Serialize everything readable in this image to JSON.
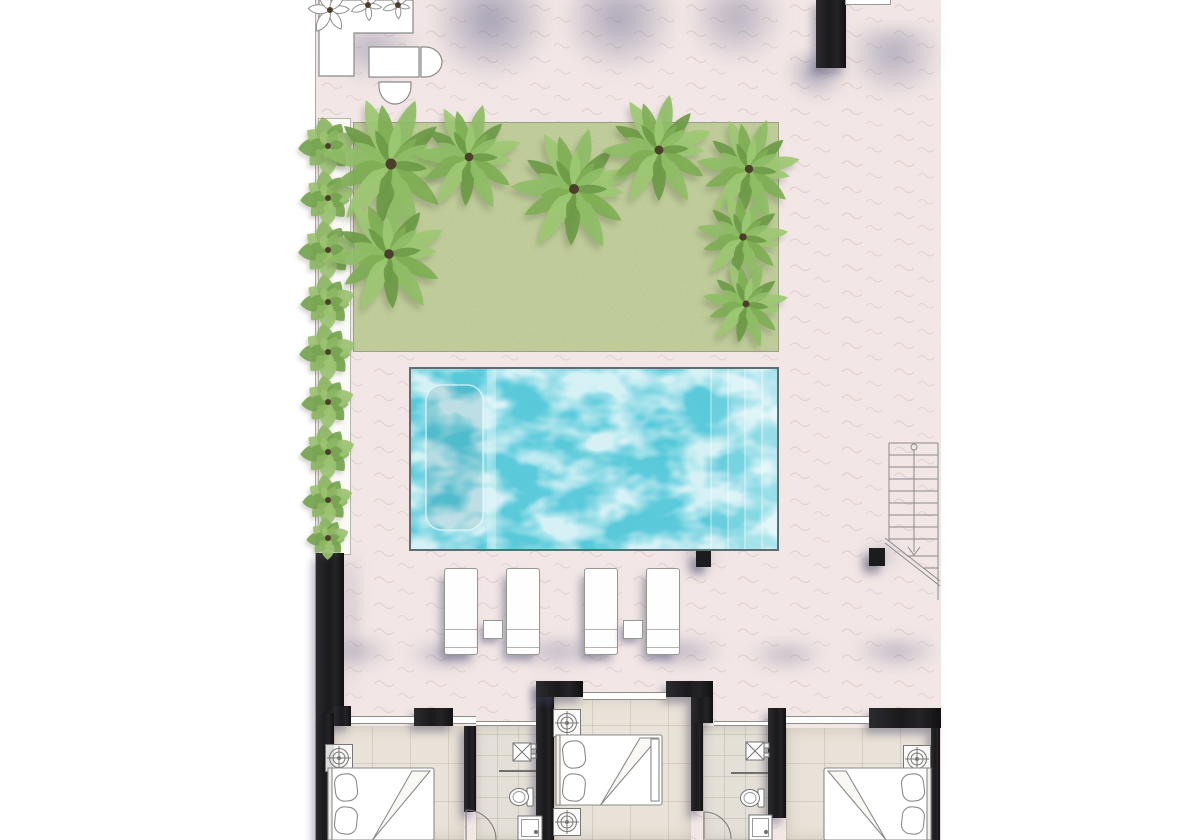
{
  "meta": {
    "title": "Villa ground-floor plan with pool, lawn and bedrooms",
    "type": "architectural-floor-plan",
    "visible_text": []
  },
  "palette": {
    "margin": "#ffffff",
    "deck": "#f4eae9",
    "deck_squiggle": "#dcc9c7",
    "shadow_tint": "88,90,130",
    "lawn": "#cdd8a4",
    "lawn_border": "#98a183",
    "pool_base": "#5ecbdc",
    "pool_highlight": "#ffffff",
    "pool_deep": "#1490ab",
    "pool_border": "#5c6e72",
    "wall": "#1c1c1e",
    "bedroom_floor": "#e9e2d8",
    "bathroom_floor": "#e4dfd7",
    "outline": "#8a8a8a",
    "furniture_fill": "#ffffff",
    "hedge_greens": [
      "#8cb663",
      "#76a44f",
      "#9cc273"
    ],
    "palm_greens": [
      "#9dc873",
      "#7fae55",
      "#8fbd66",
      "#6c9a47"
    ],
    "trunk": "#4b3e2b"
  },
  "deck_shadows": [
    {
      "x": 112,
      "y": -14,
      "w": 125,
      "h": 96,
      "o": 0.5
    },
    {
      "x": 243,
      "y": -14,
      "w": 120,
      "h": 90,
      "o": 0.45
    },
    {
      "x": 370,
      "y": -10,
      "w": 100,
      "h": 76,
      "o": 0.38
    },
    {
      "x": 528,
      "y": 28,
      "w": 100,
      "h": 72,
      "o": 0.4
    },
    {
      "x": 470,
      "y": 56,
      "w": 62,
      "h": 44,
      "o": 0.5
    },
    {
      "x": 6,
      "y": 28,
      "w": 100,
      "h": 56,
      "o": 0.35
    },
    {
      "x": 26,
      "y": 556,
      "w": 18,
      "h": 150,
      "o": 0.3
    },
    {
      "x": 2,
      "y": 640,
      "w": 75,
      "h": 30,
      "o": 0.33
    },
    {
      "x": 90,
      "y": 644,
      "w": 75,
      "h": 28,
      "o": 0.33
    },
    {
      "x": 200,
      "y": 640,
      "w": 85,
      "h": 30,
      "o": 0.35
    },
    {
      "x": 325,
      "y": 640,
      "w": 85,
      "h": 30,
      "o": 0.35
    },
    {
      "x": 430,
      "y": 644,
      "w": 80,
      "h": 28,
      "o": 0.33
    },
    {
      "x": 535,
      "y": 640,
      "w": 90,
      "h": 30,
      "o": 0.35
    },
    {
      "x": 360,
      "y": 545,
      "w": 45,
      "h": 26,
      "o": 0.3
    },
    {
      "x": 545,
      "y": 545,
      "w": 40,
      "h": 26,
      "o": 0.3
    }
  ],
  "planter": {
    "x": 2,
    "y": 118,
    "w": 33,
    "h": 437
  },
  "lawn": {
    "x": 37,
    "y": 122,
    "w": 426,
    "h": 230
  },
  "hedge": {
    "cx": 12,
    "bushes": [
      {
        "y": 146,
        "r": 29
      },
      {
        "y": 198,
        "r": 27
      },
      {
        "y": 250,
        "r": 29
      },
      {
        "y": 302,
        "r": 27
      },
      {
        "y": 352,
        "r": 28
      },
      {
        "y": 402,
        "r": 26
      },
      {
        "y": 452,
        "r": 27
      },
      {
        "y": 500,
        "r": 25
      },
      {
        "y": 538,
        "r": 21
      }
    ]
  },
  "trees": [
    {
      "x": 75,
      "y": 164,
      "r": 68
    },
    {
      "x": 153,
      "y": 157,
      "r": 54
    },
    {
      "x": 258,
      "y": 189,
      "r": 62
    },
    {
      "x": 343,
      "y": 150,
      "r": 56
    },
    {
      "x": 433,
      "y": 169,
      "r": 52
    },
    {
      "x": 73,
      "y": 254,
      "r": 60
    },
    {
      "x": 427,
      "y": 237,
      "r": 46
    },
    {
      "x": 430,
      "y": 304,
      "r": 43
    }
  ],
  "pool": {
    "x": 93,
    "y": 367,
    "w": 370,
    "h": 184,
    "ledge": {
      "x": 17,
      "y": 18,
      "w": 57,
      "h": 145,
      "r": 16
    },
    "divider_x": 82,
    "step_w": 17,
    "steps": [
      {
        "x": 302
      },
      {
        "x": 319
      },
      {
        "x": 336
      },
      {
        "x": 353
      }
    ]
  },
  "loungers": {
    "w": 34,
    "h": 87,
    "items": [
      {
        "x": 128,
        "y": 568
      },
      {
        "x": 190,
        "y": 568
      },
      {
        "x": 268,
        "y": 568
      },
      {
        "x": 330,
        "y": 568
      }
    ]
  },
  "side_tables": {
    "w": 20,
    "h": 19,
    "items": [
      {
        "x": 167,
        "y": 620
      },
      {
        "x": 307,
        "y": 620
      }
    ]
  },
  "columns": [
    {
      "x": 380,
      "y": 551,
      "w": 15,
      "h": 16
    },
    {
      "x": 553,
      "y": 548,
      "w": 16,
      "h": 18
    }
  ],
  "stairs": {
    "left": 573,
    "right": 622,
    "top": 443,
    "left_bottom": 541,
    "right_bottom": 600,
    "center_x": 598,
    "center_top": 450,
    "center_bottom": 552,
    "circle": {
      "y": 447,
      "r": 3
    },
    "treads": [
      455,
      467,
      479,
      491,
      503,
      515,
      527,
      539
    ],
    "arrow": {
      "y1": 547,
      "y2": 555,
      "spread": 6
    },
    "break_lines": [
      {
        "x1": 569,
        "y1": 538,
        "x2": 624,
        "y2": 581
      },
      {
        "x1": 569,
        "y1": 543,
        "x2": 624,
        "y2": 586
      }
    ],
    "sub_treads": [
      {
        "x1": 591,
        "x2": 622,
        "y": 556
      },
      {
        "x1": 607,
        "x2": 622,
        "y": 568
      }
    ]
  },
  "walls": [
    {
      "name": "wall-top-outdoor",
      "x": 500,
      "y": 0,
      "w": 30,
      "h": 68
    },
    {
      "name": "wall-left-upper",
      "x": 0,
      "y": 553,
      "w": 28,
      "h": 160
    },
    {
      "name": "wall-left-stub",
      "x": 18,
      "y": 706,
      "w": 17,
      "h": 20
    },
    {
      "name": "wall-left-lower",
      "x": 0,
      "y": 713,
      "w": 18,
      "h": 127
    },
    {
      "name": "wall-pier-b",
      "x": 98,
      "y": 708,
      "w": 39,
      "h": 18
    },
    {
      "name": "wall-bath1-left",
      "x": 148,
      "y": 726,
      "w": 12,
      "h": 86
    },
    {
      "name": "wall-c",
      "x": 220,
      "y": 681,
      "w": 18,
      "h": 159
    },
    {
      "name": "wall-c-top",
      "x": 220,
      "y": 681,
      "w": 47,
      "h": 16
    },
    {
      "name": "wall-d-top",
      "x": 350,
      "y": 681,
      "w": 47,
      "h": 16
    },
    {
      "name": "wall-d-mid",
      "x": 375,
      "y": 697,
      "w": 22,
      "h": 26
    },
    {
      "name": "wall-d-lower",
      "x": 375,
      "y": 723,
      "w": 12,
      "h": 88
    },
    {
      "name": "wall-e",
      "x": 452,
      "y": 708,
      "w": 18,
      "h": 110
    },
    {
      "name": "wall-pier-f",
      "x": 553,
      "y": 708,
      "w": 72,
      "h": 20
    },
    {
      "name": "wall-right",
      "x": 615,
      "y": 728,
      "w": 9,
      "h": 112
    }
  ],
  "windows": [
    {
      "x": 35,
      "y": 716,
      "w": 63,
      "h": 8
    },
    {
      "x": 137,
      "y": 716,
      "w": 23,
      "h": 8
    },
    {
      "x": 160,
      "y": 721,
      "w": 60,
      "h": 5
    },
    {
      "x": 267,
      "y": 692,
      "w": 83,
      "h": 8
    },
    {
      "x": 398,
      "y": 721,
      "w": 54,
      "h": 5
    },
    {
      "x": 470,
      "y": 716,
      "w": 83,
      "h": 8
    }
  ],
  "rooms": [
    {
      "name": "bedroom-left",
      "kind": "bedroom",
      "x": 18,
      "y": 726,
      "w": 130,
      "h": 114
    },
    {
      "name": "bathroom-1",
      "kind": "bathroom",
      "x": 160,
      "y": 726,
      "w": 60,
      "h": 114
    },
    {
      "name": "bedroom-middle",
      "kind": "bedroom",
      "x": 238,
      "y": 697,
      "w": 137,
      "h": 143
    },
    {
      "name": "bathroom-2",
      "kind": "bathroom",
      "x": 387,
      "y": 726,
      "w": 65,
      "h": 114
    },
    {
      "name": "bedroom-right",
      "kind": "bedroom",
      "x": 470,
      "y": 728,
      "w": 145,
      "h": 112
    }
  ],
  "fixtures": {
    "fan_size": 27,
    "fans": [
      {
        "cx": 23,
        "cy": 758
      },
      {
        "cx": 251,
        "cy": 723
      },
      {
        "cx": 251,
        "cy": 822
      },
      {
        "cx": 601,
        "cy": 759
      }
    ],
    "sinks": [
      {
        "cx": 206,
        "cy": 752
      },
      {
        "cx": 439,
        "cy": 751
      }
    ],
    "toilets": [
      {
        "cx": 206,
        "cy": 797
      },
      {
        "cx": 437,
        "cy": 798
      }
    ],
    "showers": [
      {
        "x": 202,
        "y": 816,
        "w": 24,
        "h": 24
      },
      {
        "x": 433,
        "y": 815,
        "w": 23,
        "h": 25
      }
    ],
    "partitions": [
      {
        "x1": 183,
        "x2": 220,
        "y": 771
      },
      {
        "x1": 415,
        "x2": 452,
        "y": 773
      }
    ],
    "doors": [
      {
        "hx": 150,
        "hy": 840,
        "r": 30
      },
      {
        "hx": 388,
        "hy": 839,
        "r": 27
      }
    ]
  },
  "beds": [
    {
      "x": 12,
      "y": 768,
      "w": 106,
      "h": 72,
      "head": "left"
    },
    {
      "x": 240,
      "y": 735,
      "w": 106,
      "h": 70,
      "head": "left",
      "footboard": true
    },
    {
      "x": 508,
      "y": 768,
      "w": 107,
      "h": 72,
      "head": "right"
    }
  ],
  "kitchen": {
    "poly": "3,0 97,0 97,33 38,33 38,76 3,76",
    "plant": {
      "cx": 14,
      "cy": 10,
      "r": 24
    },
    "sprigs": [
      {
        "cx": 52,
        "cy": 5,
        "r": 17
      },
      {
        "cx": 82,
        "cy": 5,
        "r": 15
      }
    ],
    "table": {
      "x": 53,
      "y": 47,
      "w": 50,
      "h": 30
    },
    "chair_right": {
      "x": 105,
      "y": 47,
      "w": 32,
      "h": 30
    },
    "chair_bottom": {
      "x": 63,
      "y": 82,
      "w": 32,
      "h": 30
    }
  },
  "counter_sliver": {
    "x": 529,
    "y": 0,
    "w": 46,
    "h": 5
  }
}
